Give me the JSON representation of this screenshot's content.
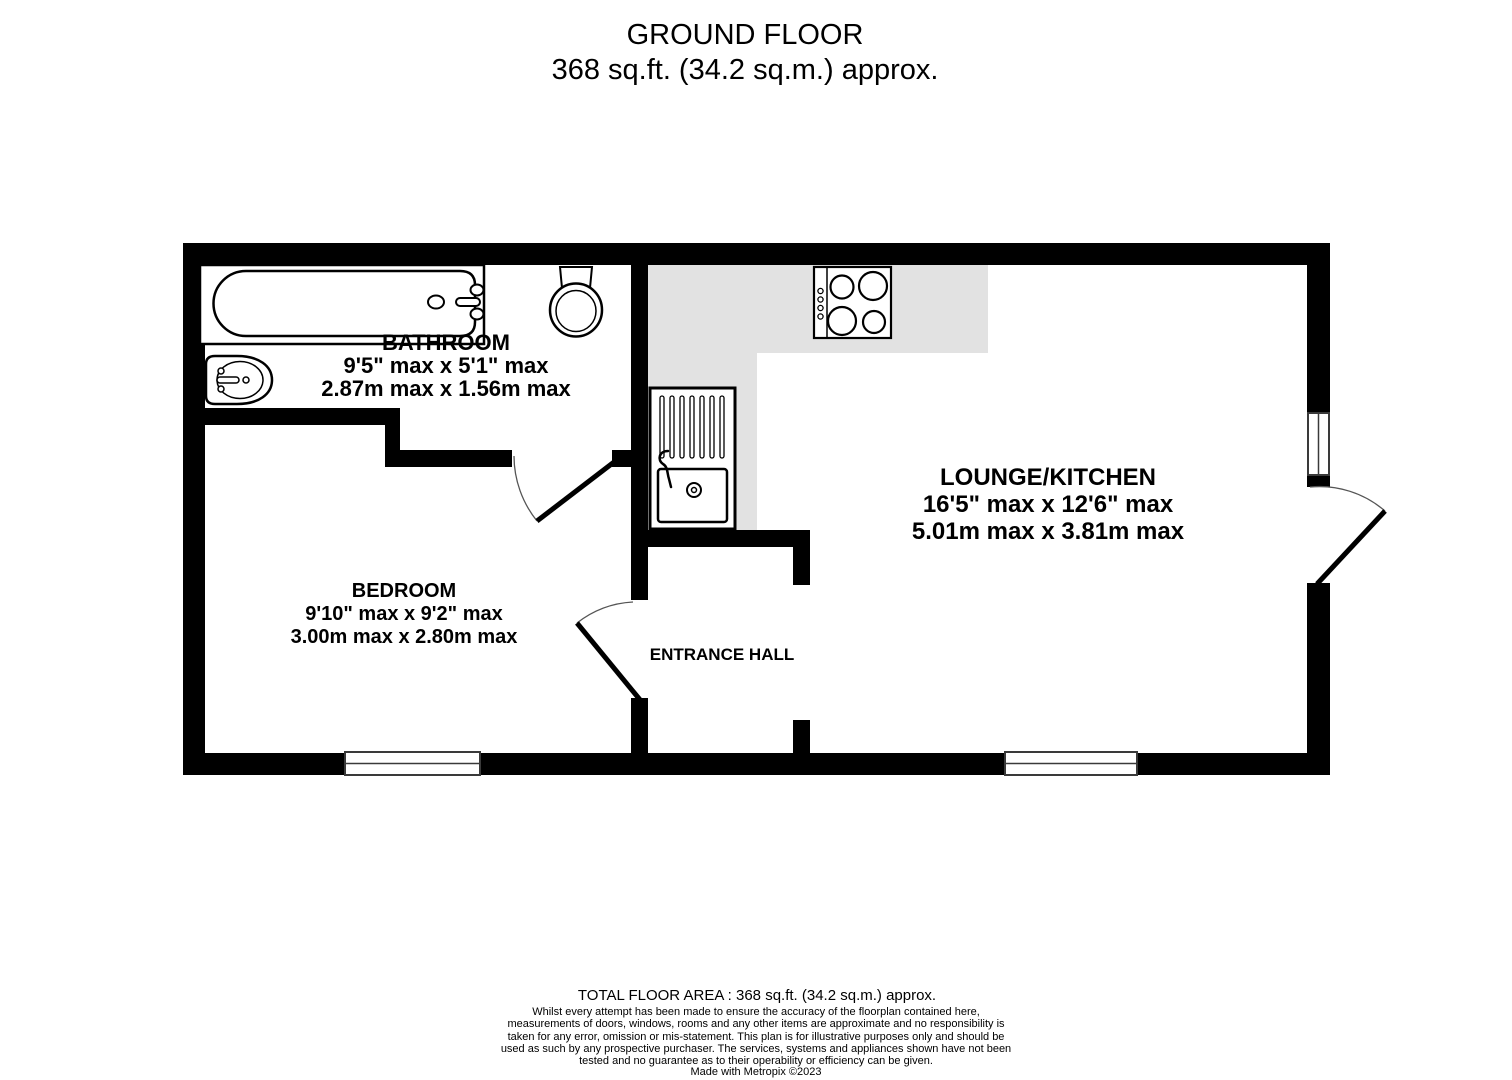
{
  "header": {
    "title": "GROUND FLOOR",
    "subtitle": "368 sq.ft. (34.2 sq.m.) approx."
  },
  "rooms": {
    "bathroom": {
      "name": "BATHROOM",
      "dimensions_imperial": "9'5\" max x 5'1\" max",
      "dimensions_metric": "2.87m max x 1.56m max"
    },
    "bedroom": {
      "name": "BEDROOM",
      "dimensions_imperial": "9'10\" max x 9'2\" max",
      "dimensions_metric": "3.00m max x 2.80m max"
    },
    "lounge_kitchen": {
      "name": "LOUNGE/KITCHEN",
      "dimensions_imperial": "16'5\" max x 12'6\" max",
      "dimensions_metric": "5.01m max x 3.81m max"
    },
    "entrance_hall": {
      "name": "ENTRANCE HALL"
    }
  },
  "fixtures": {
    "bathtub": "bathtub-icon",
    "toilet": "toilet-icon",
    "basin": "basin-icon",
    "hob": "hob-icon",
    "kitchen_sink": "kitchen-sink-icon"
  },
  "footer": {
    "total_area": "TOTAL FLOOR AREA : 368 sq.ft. (34.2 sq.m.) approx.",
    "disclaimer": "Whilst every attempt has been made to ensure the accuracy of the floorplan contained here, measurements of doors, windows, rooms and any other items are approximate and no responsibility is taken for any error, omission or mis-statement. This plan is for illustrative purposes only and should be used as such by any prospective purchaser. The services, systems and appliances shown have not been tested and no guarantee as to their operability or efficiency can be given.",
    "credit": "Made with Metropix ©2023"
  },
  "colors": {
    "wall": "#000000",
    "counter": "#e2e2e2",
    "door_arc": "#555555",
    "window_frame": "#3a3a3a",
    "background": "#ffffff",
    "text": "#000000"
  }
}
